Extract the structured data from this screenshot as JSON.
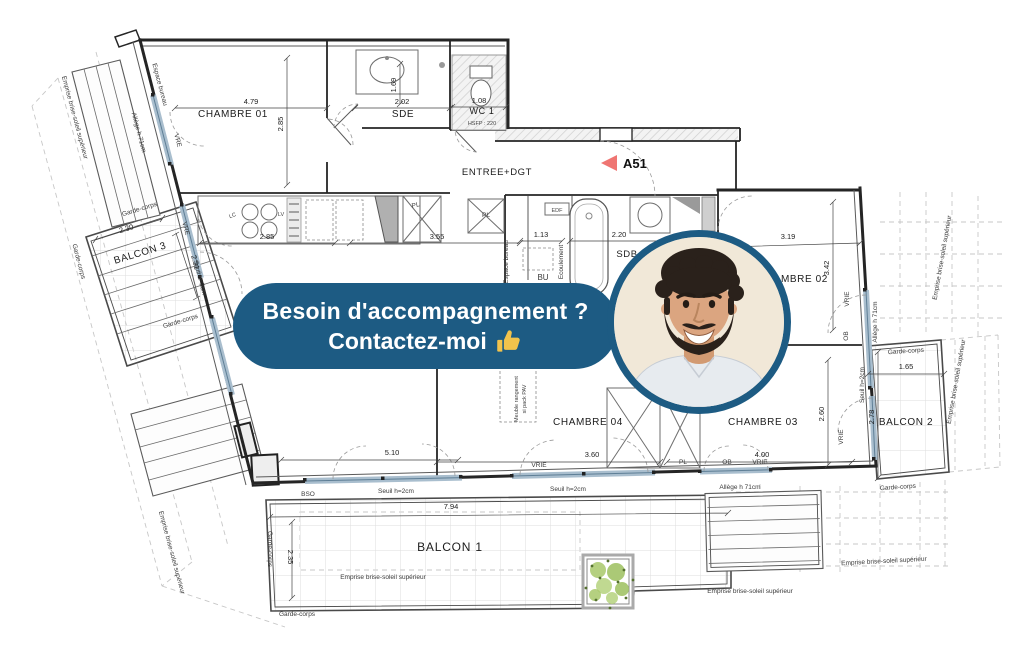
{
  "overlay": {
    "banner": {
      "line1": "Besoin d'accompagnement ?",
      "line2": "Contactez-moi",
      "bg_color": "#1d5b83",
      "thumb_color": "#f2c34c"
    },
    "avatar": {
      "border_color": "#1d5b83"
    }
  },
  "plan": {
    "marker_a51": "A51",
    "colors": {
      "arrow": "#ef7572",
      "window_tint": "#a9bece"
    },
    "rooms": {
      "chambre01": "CHAMBRE 01",
      "chambre02": "CHAMBRE 02",
      "chambre03": "CHAMBRE 03",
      "chambre04": "CHAMBRE 04",
      "sde": "SDE",
      "wc1": "WC 1",
      "entree": "ENTREE+DGT",
      "sdb": "SDB",
      "balcon1": "BALCON 1",
      "balcon2": "BALCON 2",
      "balcon3": "BALCON 3"
    },
    "dims": {
      "d479": "4.79",
      "d285": "2.85",
      "d202": "2.02",
      "d169": "1.69",
      "d108": "1.08",
      "d355": "3.55",
      "d113": "1.13",
      "d220": "2.20",
      "d319": "3.19",
      "d342": "3.42",
      "d230": "2.30",
      "d231": "2.31",
      "d510": "5.10",
      "d360": "3.60",
      "d400": "4.00",
      "d260": "2.60",
      "d278": "2.78",
      "d165": "1.65",
      "d794": "7.94",
      "d235": "2.35"
    },
    "terms": {
      "garde_corps": "Garde-corps",
      "emprise": "Emprise brise-soleil supérieur",
      "allege": "Allège h 71cm",
      "seuil": "Seuil h=2cm",
      "espace_bureau": "Espace bureau",
      "ecoulement": "Ecoulement",
      "meuble_l1": "Meuble rangement",
      "meuble_l2": "si pack PAV",
      "hsfp": "HSFP : 220",
      "vre": "VRE",
      "vrie": "VRIE",
      "ob": "OB",
      "bso": "BSO",
      "bu": "BU",
      "pl": "PL",
      "lc": "LC",
      "lv": "LV",
      "edf": "EDF"
    }
  }
}
